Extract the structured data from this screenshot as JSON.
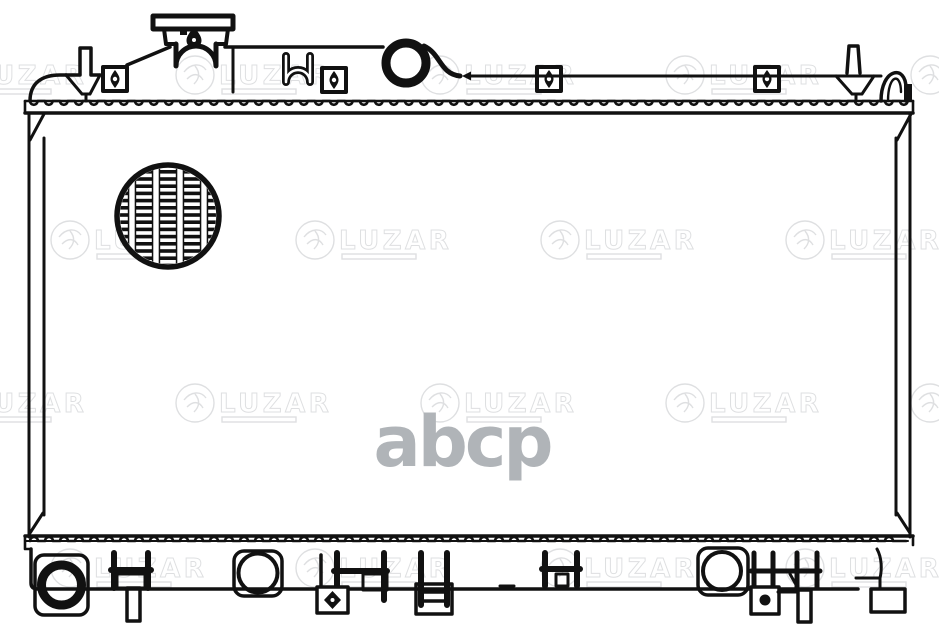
{
  "watermarks": {
    "brand_text": "LUZAR",
    "center_text": "abcp",
    "brand_color": "#b7babd",
    "brand_opacity": 0.45,
    "center_color": "#b0b4b8"
  },
  "canvas": {
    "background": "#ffffff",
    "line_color": "#111111"
  },
  "diagram_parts": {
    "filler_neck": "filler-neck-with-cap",
    "inlet_opening": "inlet-pipe-opening",
    "fin_detail": "core-fin-detail-circle",
    "mount_brackets": "mounting-bracket-with-bolt",
    "header_strip": "top-header-plate",
    "bottom_tank": "bottom-tank-assembly"
  }
}
